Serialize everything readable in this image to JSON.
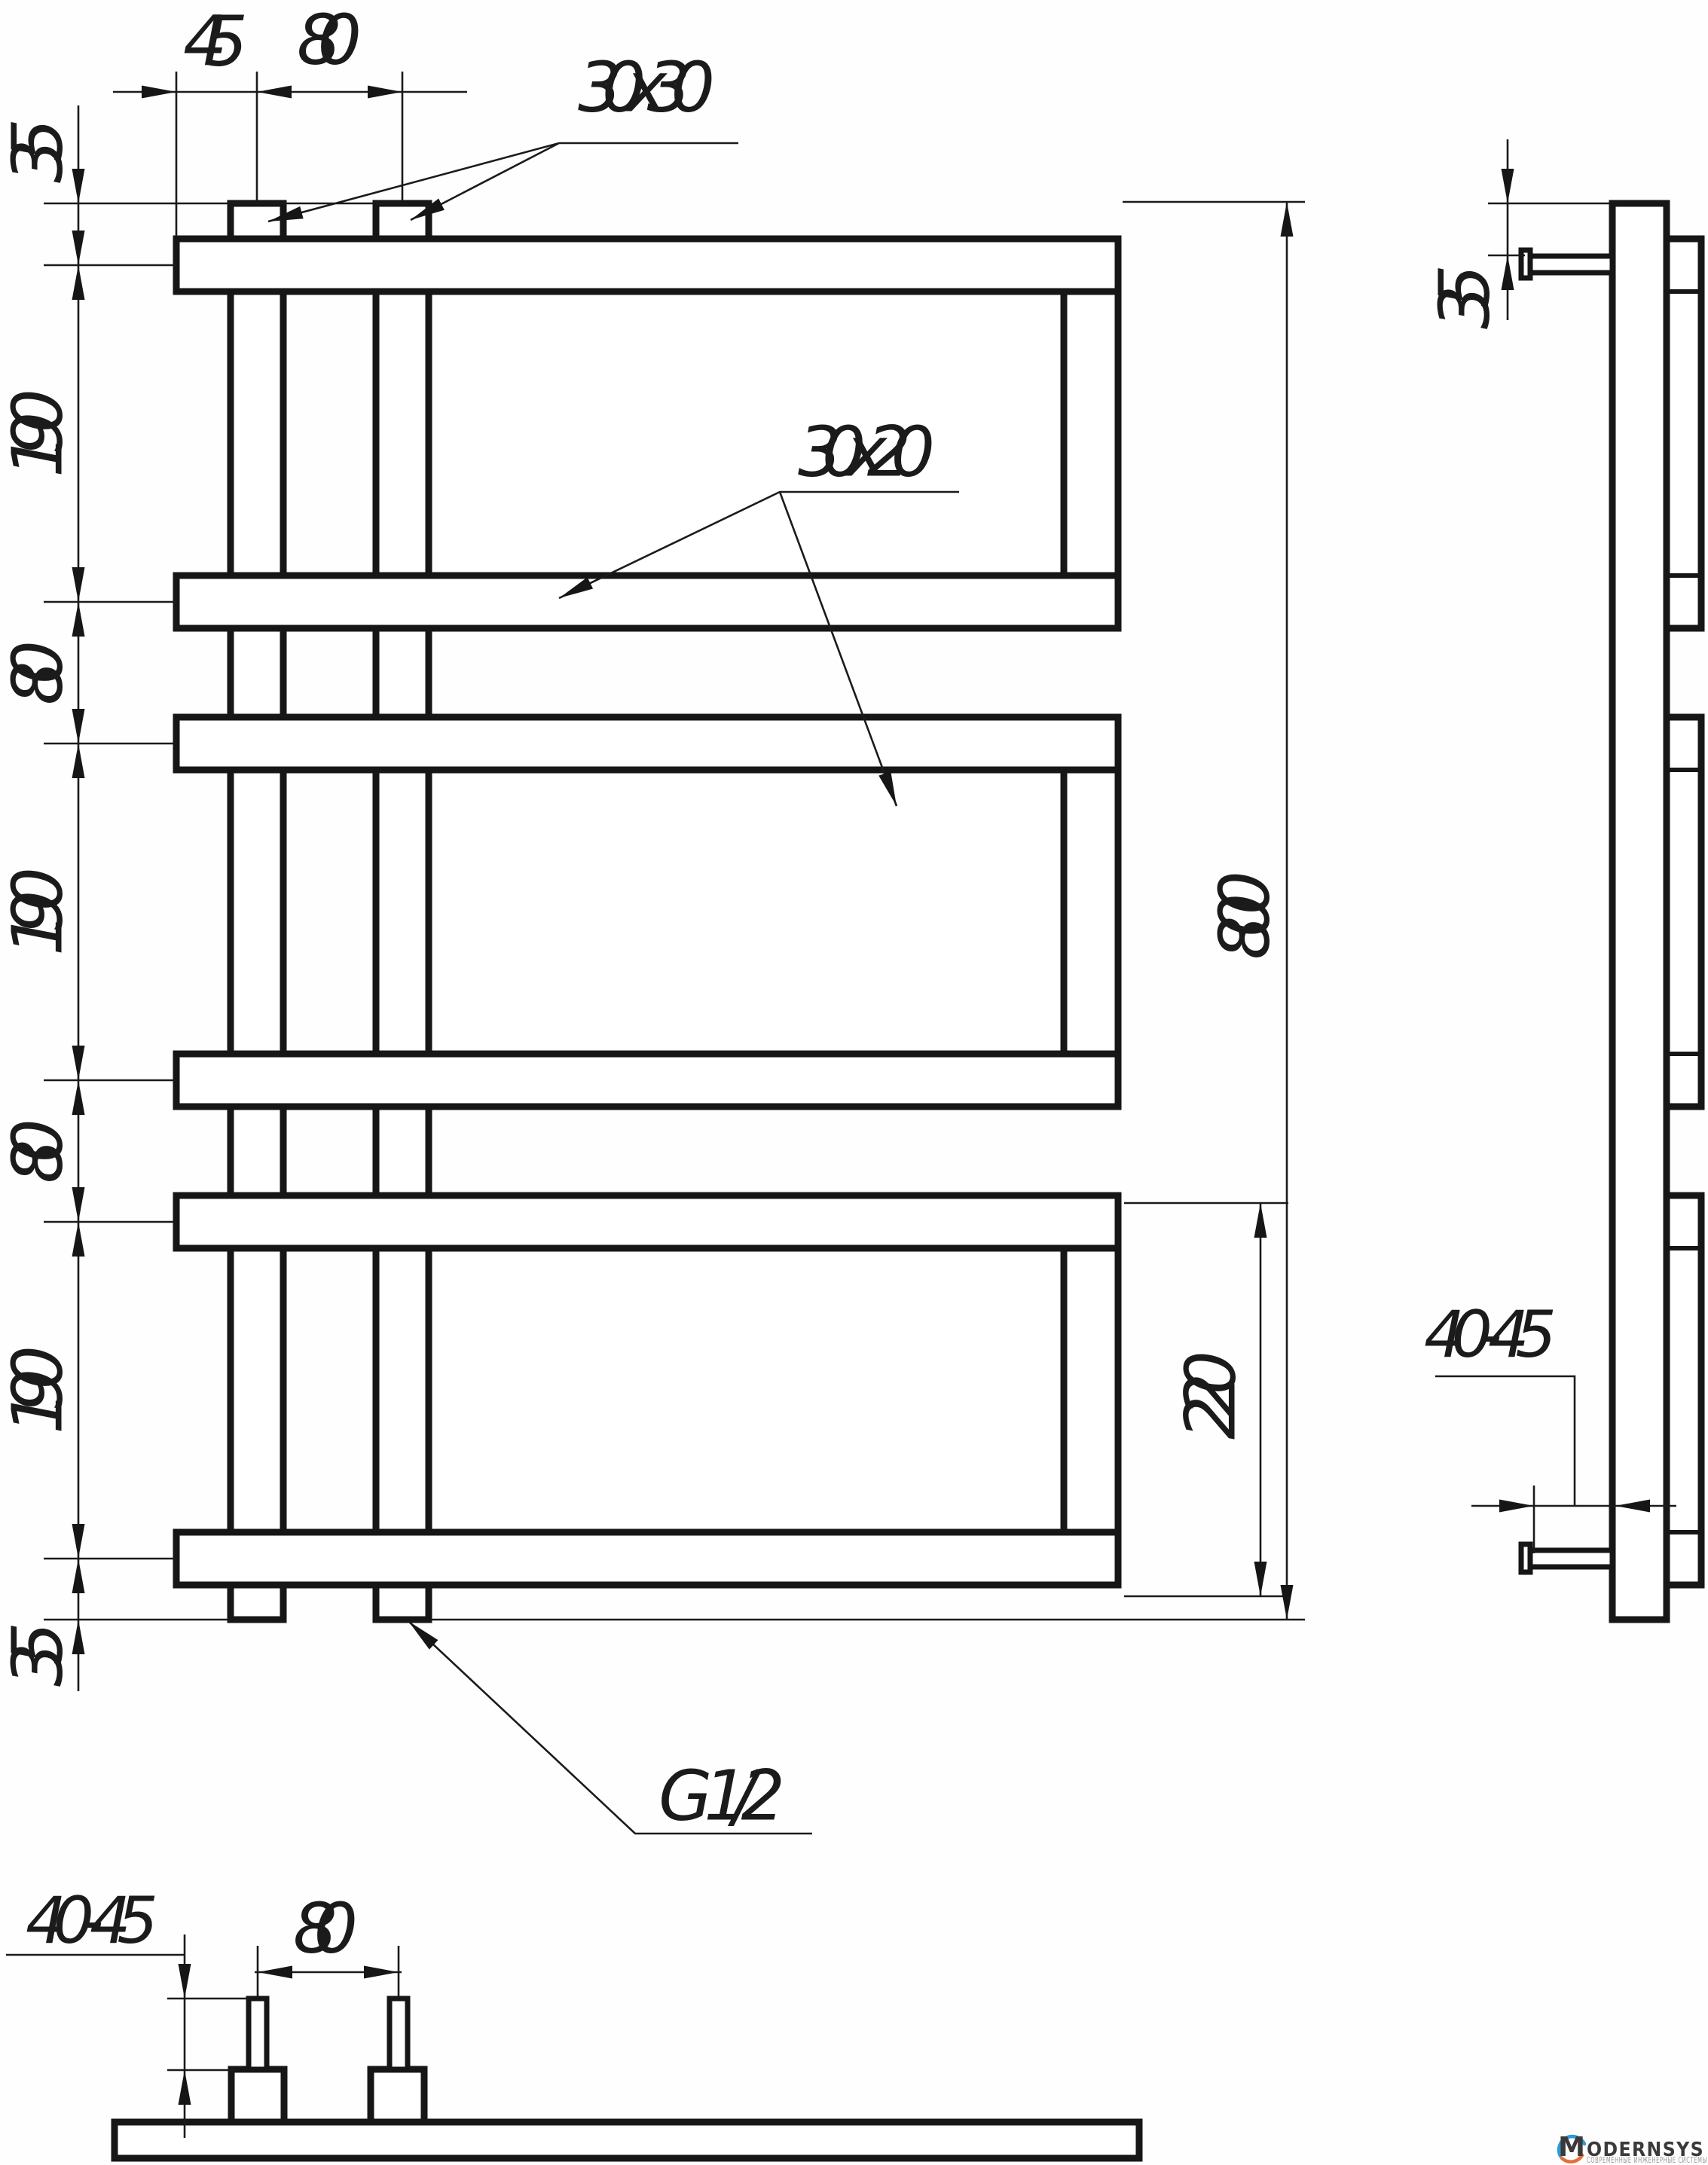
{
  "front_view": {
    "top_offset_45": "45",
    "riser_spacing_80": "80",
    "tab_profile_label": "30x30",
    "panel_profile_label": "30x20",
    "height_chain": [
      "35",
      "190",
      "80",
      "190",
      "80",
      "190",
      "35"
    ],
    "overall_height_800": "800",
    "panel_height_220": "220",
    "thread_label": "G 1/2"
  },
  "side_view": {
    "top_offset_35": "35",
    "wall_distance_40_45": "40-45"
  },
  "bottom_view": {
    "wall_distance_40_45": "40-45",
    "riser_spacing_80": "80"
  },
  "logo": {
    "brand_initial": "M",
    "brand_rest": "ODERNSYS",
    "tagline": "СОВРЕМЕННЫЕ ИНЖЕНЕРНЫЕ СИСТЕМЫ",
    "accent_blue": "#2d9ad3",
    "accent_orange": "#e4703a",
    "brand_color": "#3a3a3a",
    "tagline_color": "#9f9590"
  }
}
